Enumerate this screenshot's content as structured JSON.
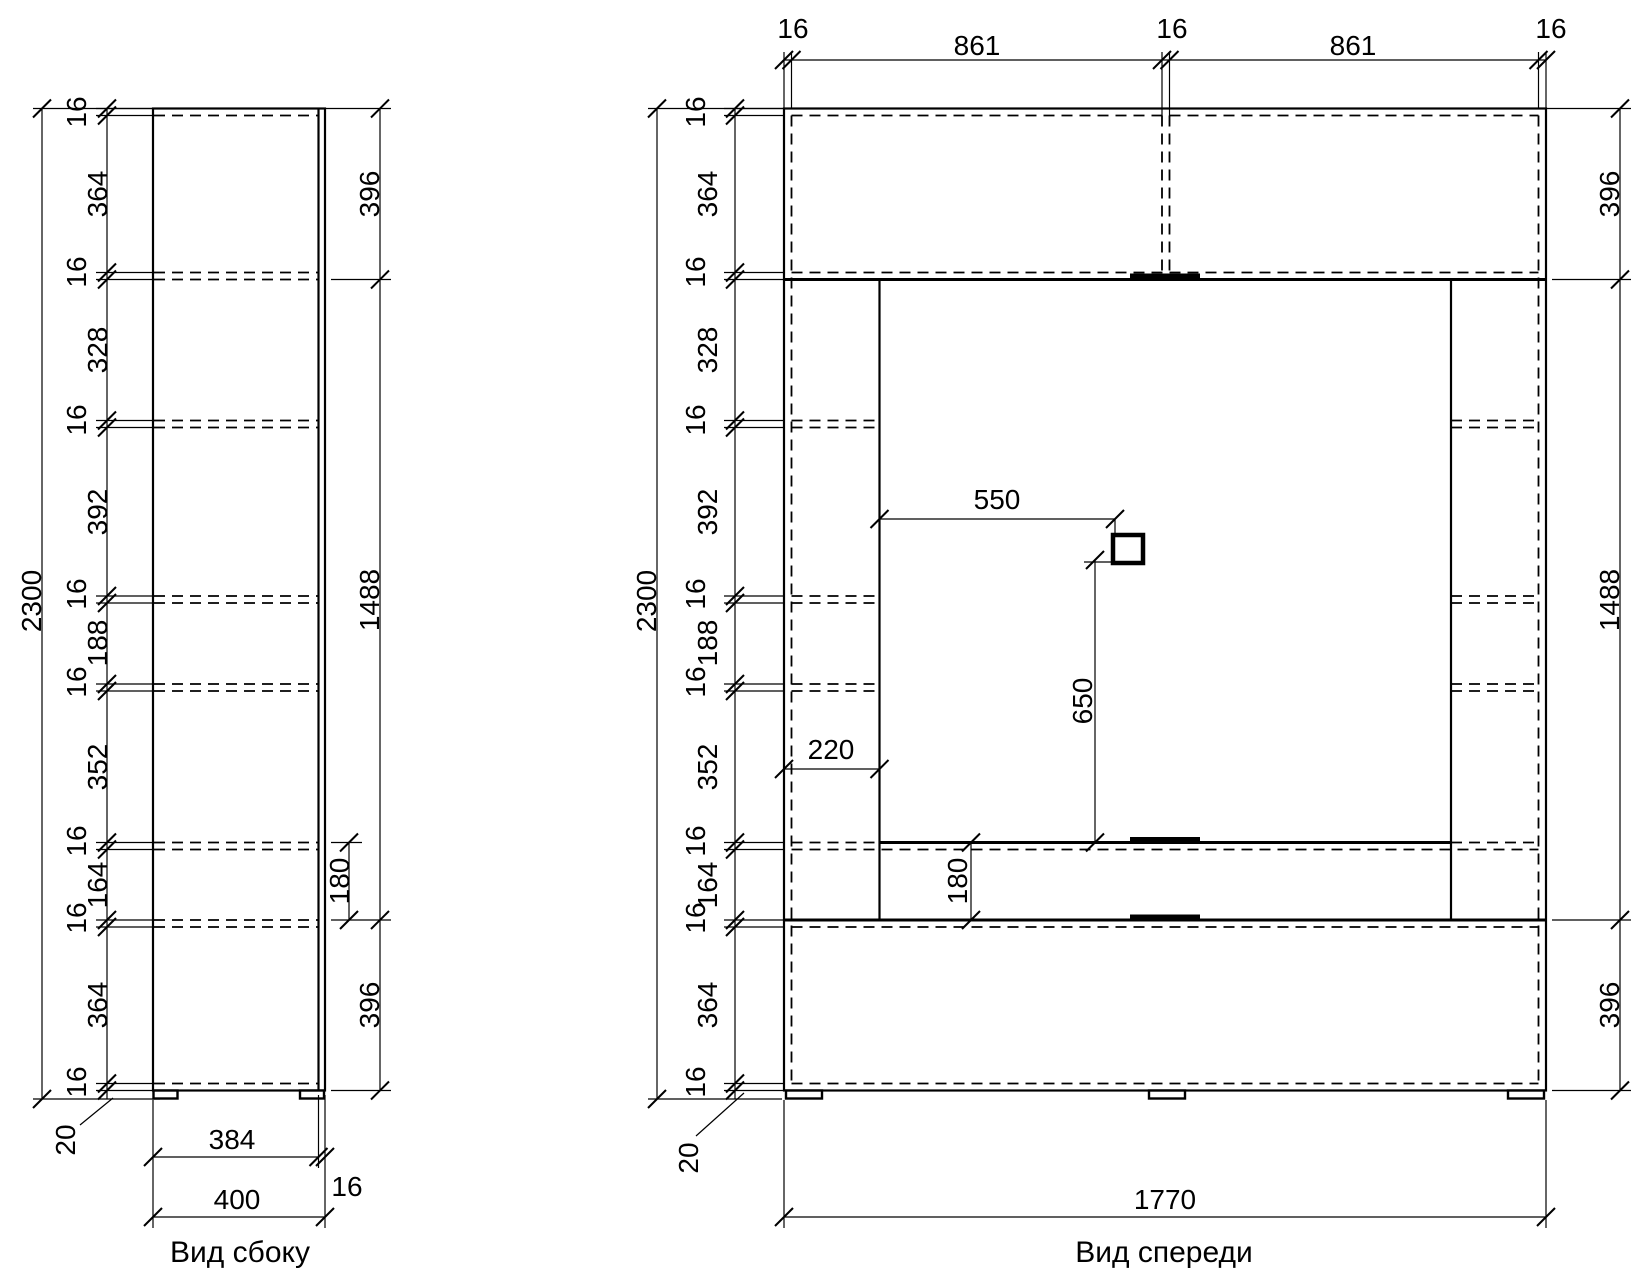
{
  "page": {
    "background": "#ffffff",
    "line_color": "#000000"
  },
  "side": {
    "title": "Вид сбоку",
    "overall_height": "2300",
    "height_chain": [
      "16",
      "364",
      "16",
      "328",
      "16",
      "392",
      "16",
      "188",
      "16",
      "352",
      "16",
      "164",
      "16",
      "364",
      "16"
    ],
    "right_dims": [
      "396",
      "1488",
      "396"
    ],
    "door_zone_dim": "180",
    "carcass_depth_dim": "384",
    "door_thickness_dim": "16",
    "total_depth_dim": "400",
    "plinth_dim": "20"
  },
  "front": {
    "title": "Вид спереди",
    "overall_height": "2300",
    "overall_width": "1770",
    "top_width_chain": [
      "16",
      "861",
      "16",
      "861",
      "16"
    ],
    "height_chain": [
      "16",
      "364",
      "16",
      "328",
      "16",
      "392",
      "16",
      "188",
      "16",
      "352",
      "16",
      "164",
      "16",
      "364",
      "16"
    ],
    "right_dims": [
      "396",
      "1488",
      "396"
    ],
    "socket_offset_x_dim": "550",
    "socket_offset_y_dim": "650",
    "left_column_dim": "220",
    "flap_height_dim": "180",
    "plinth_dim": "20"
  }
}
